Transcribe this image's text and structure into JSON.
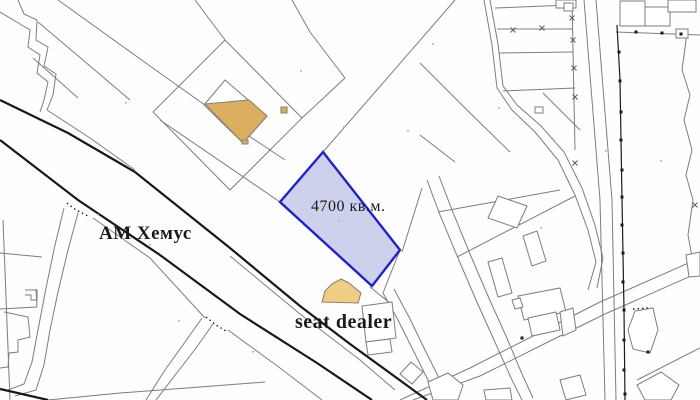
{
  "map": {
    "background": "#fefefe",
    "colors": {
      "parcel_line": "#7d7d7d",
      "road_line": "#181818",
      "boundary_line": "#1b1b1b",
      "highlight_fill": "#c8cce9",
      "highlight_stroke": "#2121cb",
      "tan_dark": "#dcae60",
      "tan_light": "#f0cd83",
      "building_fill": "#ffffff",
      "building_stroke": "#8a8274",
      "text": "#1a1a1a",
      "speck": "#b9b9b9",
      "x_mark": "#555555"
    },
    "labels": [
      {
        "id": "highway-label",
        "text": "АМ Хемус",
        "x": 99,
        "y": 224,
        "size": 19,
        "weight": "bold"
      },
      {
        "id": "area-label",
        "text": "4700 кв.м.",
        "x": 311,
        "y": 199,
        "size": 16,
        "weight": "normal"
      },
      {
        "id": "dealer-label",
        "text": "seat dealer",
        "x": 295,
        "y": 312,
        "size": 20,
        "weight": "bold"
      }
    ],
    "highlight_parcel": {
      "points": "323,152 280,202 372,286 400,250",
      "area_text": "4700 кв.м."
    },
    "thick_lines": [
      "0,100 68,133 135,172 230,248 300,306 350,344 427,400",
      "0,140 78,200 160,255 240,314 317,363 372,400",
      "0,389 48,400"
    ],
    "boundary_line": "617,25 620,80 622,200 624,310 625,400",
    "thin_lines": [
      "18,0 24,14 37,20 36,40 48,47 44,66 56,74 53,95 47,110",
      "0,12 20,24 30,30 28,47 40,55 37,73 48,82 44,100 40,112",
      "47,110 90,138 135,170",
      "38,22 90,66 130,100",
      "33,58 78,98",
      "58,0 150,66 240,130 285,160",
      "160,120 280,202",
      "370,287 390,303",
      "225,40 302,118 230,190 153,112 225,40",
      "195,0 225,40",
      "302,118 345,78",
      "345,78 310,32 292,0",
      "455,0 323,152",
      "420,63 467,110 510,152",
      "420,135 455,162",
      "484,0 492,45 497,88 512,110 535,132 558,160 575,195 588,230 596,262 588,290",
      "490,0 498,44 503,86 517,105 541,126 564,152 582,188 595,225 603,258 597,288",
      "495,8 570,5",
      "497,29 572,29",
      "499,53 573,52",
      "503,91 575,88",
      "543,93 580,130",
      "572,0 575,150",
      "584,0 600,200 605,400",
      "596,0 612,200 616,400",
      "687,33 682,70 690,95 684,120 692,150 686,175 693,200 688,235 694,268",
      "616,32 700,35",
      "402,252 422,188",
      "400,250 383,293",
      "427,180 440,215 458,258 476,300 494,340 512,380 522,400",
      "439,176 452,210 470,254 488,296 506,336 522,374 533,398",
      "383,293 398,320 414,352 428,380 441,400",
      "394,289 409,317 425,350 439,378 452,400",
      "438,212 560,190",
      "457,257 575,196",
      "400,400 470,368 545,330 600,302 700,258",
      "413,400 480,376 552,340 605,314 700,272",
      "78,213 68,250 58,292 50,330 44,365 36,390 15,396",
      "64,208 55,245 46,288 38,330 32,362 24,384 8,390",
      "213,324 196,348 176,374 156,400",
      "202,318 185,342 165,370 146,400",
      "93,218 150,258 205,318",
      "228,330 280,368 322,400",
      "3,220 10,400",
      "0,253 42,257",
      "230,256 300,314 360,360 395,390",
      "637,380 700,348",
      "48,400 120,393 200,387 265,382",
      "36,289 37,307 0,309",
      "25,290 37,290 37,300 31,300 31,295 25,295",
      "4,312 28,317 30,337 18,340 18,352 9,353 8,367 0,368"
    ],
    "white_buildings": [
      "620,1 645,1 645,26 620,26",
      "645,7 670,7 670,26 645,26",
      "668,0 696,0 696,12 668,12",
      "676,29 688,29 688,38 676,38",
      "556,0 576,0 576,8 556,8",
      "564,3 573,3 573,11 564,11",
      "535,107 543,107 543,113 535,113",
      "488,218 498,196 527,206 517,228",
      "523,236 537,231 546,261 532,266",
      "488,262 502,258 512,293 498,297",
      "518,296 560,288 566,312 524,320",
      "528,318 556,312 560,330 532,336",
      "512,300 520,298 523,307 515,309",
      "411,362 423,372 412,384 400,374",
      "428,382 448,373 463,385 458,400 433,400",
      "484,390 510,388 512,400 486,400",
      "560,380 580,375 586,395 566,400",
      "628,330 635,311 653,308 658,330 650,353 633,349",
      "637,385 661,372 679,385 671,400 645,400",
      "686,255 700,252 700,276 689,277",
      "362,306 392,302 396,338 366,342",
      "366,342 390,339 392,352 368,355",
      "560,312 573,308 576,330 563,336"
    ],
    "tan_buildings": [
      {
        "name": "barn-outline",
        "points": "225,80 267,116 243,143 204,105",
        "fill": "#ffffff"
      },
      {
        "name": "barn-building",
        "points": "205,104 249,100 267,116 243,143",
        "fill": "#dcae60"
      },
      {
        "name": "dealer-building",
        "points": "322,302 325,291 332,284 341,279 349,283 355,288 361,293 358,303",
        "fill": "#f0cd83"
      },
      {
        "name": "small-marker-building",
        "points": "281,107 287,107 287,113 281,113",
        "fill": "#d8b04f"
      },
      {
        "name": "tiny-marker-building",
        "points": "242,140 248,140 248,144 242,144",
        "fill": "#c9b958"
      }
    ],
    "dotted_lines": [
      "67,203 76,210 88,216",
      "206,317 216,325 226,331",
      "633,309 648,308"
    ],
    "black_dots": [
      [
        619,
        52
      ],
      [
        620,
        81
      ],
      [
        621,
        112
      ],
      [
        621,
        140
      ],
      [
        622,
        170
      ],
      [
        622,
        197
      ],
      [
        622,
        225
      ],
      [
        623,
        253
      ],
      [
        623,
        282
      ],
      [
        624,
        310
      ],
      [
        624,
        340
      ],
      [
        624,
        370
      ],
      [
        625,
        394
      ],
      [
        636,
        32
      ],
      [
        662,
        33
      ],
      [
        681,
        34
      ],
      [
        648,
        352
      ],
      [
        522,
        338
      ]
    ],
    "x_marks": [
      [
        513,
        30
      ],
      [
        542,
        28
      ],
      [
        572,
        18
      ],
      [
        573,
        40
      ],
      [
        574,
        68
      ],
      [
        575,
        97
      ],
      [
        575,
        163
      ],
      [
        695,
        205
      ]
    ],
    "specks": [
      [
        125,
        102
      ],
      [
        149,
        244
      ],
      [
        252,
        351
      ],
      [
        343,
        126
      ],
      [
        407,
        130
      ],
      [
        498,
        107
      ],
      [
        540,
        227
      ],
      [
        660,
        160
      ],
      [
        97,
        214
      ],
      [
        338,
        220
      ],
      [
        178,
        320
      ],
      [
        300,
        70
      ],
      [
        432,
        43
      ],
      [
        605,
        150
      ]
    ]
  }
}
